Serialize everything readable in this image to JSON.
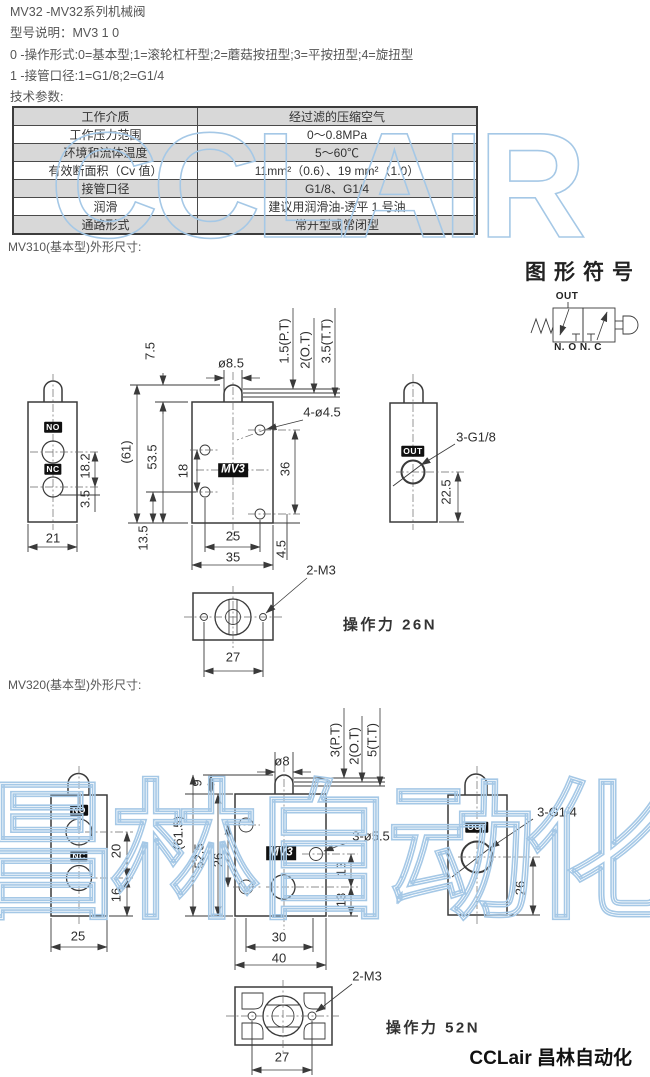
{
  "page": {
    "title_line": "MV32 -MV32系列机械阀",
    "model_line": "型号说明：MV3 1 0",
    "code_line_0": "0 -操作形式:0=基本型;1=滚轮杠杆型;2=蘑菇按扭型;3=平按扭型;4=旋扭型",
    "code_line_1": "1 -接管口径:1=G1/8;2=G1/4",
    "tech_params_heading": "技术参数:",
    "footer_brand": "CCLair 昌林自动化"
  },
  "watermarks": {
    "table_watermark": "CCLAIR",
    "drawing_watermark": "昌林自动化",
    "outline_color": "#a5c8e6"
  },
  "spec_table": {
    "rows": [
      {
        "name": "工作介质",
        "value": "经过滤的压缩空气",
        "shaded": true
      },
      {
        "name": "工作压力范围",
        "value": "0～0.8MPa",
        "shaded": false
      },
      {
        "name": "环境和流体温度",
        "value": "5～60℃",
        "shaded": true
      },
      {
        "name": "有效断面积（Cv 值）",
        "value": "11mm²（0.6）、19 mm²（1.0）",
        "shaded": false
      },
      {
        "name": "接管口径",
        "value": "G1/8、G1/4",
        "shaded": true
      },
      {
        "name": "润滑",
        "value": "建议用润滑油-透平 1 号油",
        "shaded": false
      },
      {
        "name": "通路形式",
        "value": "常开型或常闭型",
        "shaded": true
      }
    ]
  },
  "symbol": {
    "heading": "图形符号",
    "labels": [
      {
        "t": "OUT",
        "x": 567,
        "y": 297,
        "cls": "sym",
        "n": "symbol-out-label"
      },
      {
        "t": "N. O N. C",
        "x": 578,
        "y": 348,
        "cls": "sym",
        "n": "symbol-no-nc-label"
      }
    ]
  },
  "mv310": {
    "heading": "MV310(基本型)外形尺寸:",
    "labels": [
      {
        "t": "7.5",
        "x": 150,
        "y": 351,
        "cls": "dr"
      },
      {
        "t": "ø8.5",
        "x": 231,
        "y": 363,
        "cls": "d"
      },
      {
        "t": "1.5(P.T)",
        "x": 284,
        "y": 341,
        "cls": "dr"
      },
      {
        "t": "2(O.T)",
        "x": 305,
        "y": 350,
        "cls": "dr"
      },
      {
        "t": "3.5(T.T)",
        "x": 326,
        "y": 341,
        "cls": "dr"
      },
      {
        "t": "(61)",
        "x": 126,
        "y": 452,
        "cls": "dr"
      },
      {
        "t": "53.5",
        "x": 152,
        "y": 457,
        "cls": "dr"
      },
      {
        "t": "18",
        "x": 183,
        "y": 471,
        "cls": "dr"
      },
      {
        "t": "36",
        "x": 285,
        "y": 469,
        "cls": "dr"
      },
      {
        "t": "4-ø4.5",
        "x": 322,
        "y": 412,
        "cls": "lead",
        "n": "leader-label"
      },
      {
        "t": "18.2",
        "x": 85,
        "y": 466,
        "cls": "dr"
      },
      {
        "t": "3.5",
        "x": 85,
        "y": 499,
        "cls": "dr"
      },
      {
        "t": "21",
        "x": 53,
        "y": 538,
        "cls": "d"
      },
      {
        "t": "13.5",
        "x": 143,
        "y": 538,
        "cls": "dr"
      },
      {
        "t": "25",
        "x": 233,
        "y": 536,
        "cls": "d"
      },
      {
        "t": "35",
        "x": 233,
        "y": 557,
        "cls": "d"
      },
      {
        "t": "4.5",
        "x": 281,
        "y": 549,
        "cls": "dr"
      },
      {
        "t": "2-M3",
        "x": 321,
        "y": 570,
        "cls": "lead",
        "n": "leader-label"
      },
      {
        "t": "3-G1/8",
        "x": 476,
        "y": 437,
        "cls": "lead",
        "n": "leader-label"
      },
      {
        "t": "22.5",
        "x": 446,
        "y": 492,
        "cls": "dr"
      },
      {
        "t": "27",
        "x": 233,
        "y": 657,
        "cls": "d"
      },
      {
        "t": "NO",
        "x": 53,
        "y": 427,
        "cls": "tag",
        "n": "port-tag-no"
      },
      {
        "t": "NC",
        "x": 53,
        "y": 469,
        "cls": "tag",
        "n": "port-tag-nc"
      },
      {
        "t": "MV3",
        "x": 233,
        "y": 470,
        "cls": "tagbig",
        "n": "model-tag"
      },
      {
        "t": "OUT",
        "x": 413,
        "y": 451,
        "cls": "tag",
        "n": "port-tag-out"
      },
      {
        "t": "操作力 26N",
        "x": 390,
        "y": 625,
        "cls": "force",
        "n": "operating-force-label"
      }
    ]
  },
  "mv320": {
    "heading": "MV320(基本型)外形尺寸:",
    "labels": [
      {
        "t": "ø8",
        "x": 282,
        "y": 761,
        "cls": "d"
      },
      {
        "t": "9",
        "x": 197,
        "y": 783,
        "cls": "dr"
      },
      {
        "t": "3(P.T)",
        "x": 335,
        "y": 740,
        "cls": "dr"
      },
      {
        "t": "2(O.T)",
        "x": 354,
        "y": 746,
        "cls": "dr"
      },
      {
        "t": "5(T.T)",
        "x": 372,
        "y": 740,
        "cls": "dr"
      },
      {
        "t": "(61.5)",
        "x": 178,
        "y": 833,
        "cls": "dr"
      },
      {
        "t": "52.5",
        "x": 199,
        "y": 856,
        "cls": "dr"
      },
      {
        "t": "26",
        "x": 218,
        "y": 860,
        "cls": "dr"
      },
      {
        "t": "20",
        "x": 116,
        "y": 851,
        "cls": "dr"
      },
      {
        "t": "16",
        "x": 116,
        "y": 895,
        "cls": "dr"
      },
      {
        "t": "25",
        "x": 78,
        "y": 936,
        "cls": "d"
      },
      {
        "t": "3-ø5.5",
        "x": 371,
        "y": 836,
        "cls": "lead",
        "n": "leader-label"
      },
      {
        "t": "13",
        "x": 341,
        "y": 869,
        "cls": "dr"
      },
      {
        "t": "13",
        "x": 341,
        "y": 900,
        "cls": "dr"
      },
      {
        "t": "30",
        "x": 279,
        "y": 937,
        "cls": "d"
      },
      {
        "t": "40",
        "x": 279,
        "y": 958,
        "cls": "d"
      },
      {
        "t": "3-G1/4",
        "x": 557,
        "y": 812,
        "cls": "lead",
        "n": "leader-label"
      },
      {
        "t": "26",
        "x": 520,
        "y": 888,
        "cls": "dr"
      },
      {
        "t": "2-M3",
        "x": 367,
        "y": 976,
        "cls": "lead",
        "n": "leader-label"
      },
      {
        "t": "27",
        "x": 282,
        "y": 1057,
        "cls": "d"
      },
      {
        "t": "NO",
        "x": 79,
        "y": 810,
        "cls": "tag",
        "n": "port-tag-no"
      },
      {
        "t": "NC",
        "x": 79,
        "y": 856,
        "cls": "tag",
        "n": "port-tag-nc"
      },
      {
        "t": "MV3",
        "x": 281,
        "y": 853,
        "cls": "tagbig",
        "n": "model-tag"
      },
      {
        "t": "OUT",
        "x": 477,
        "y": 827,
        "cls": "tag",
        "n": "port-tag-out"
      },
      {
        "t": "操作力 52N",
        "x": 433,
        "y": 1028,
        "cls": "force",
        "n": "operating-force-label"
      }
    ]
  }
}
